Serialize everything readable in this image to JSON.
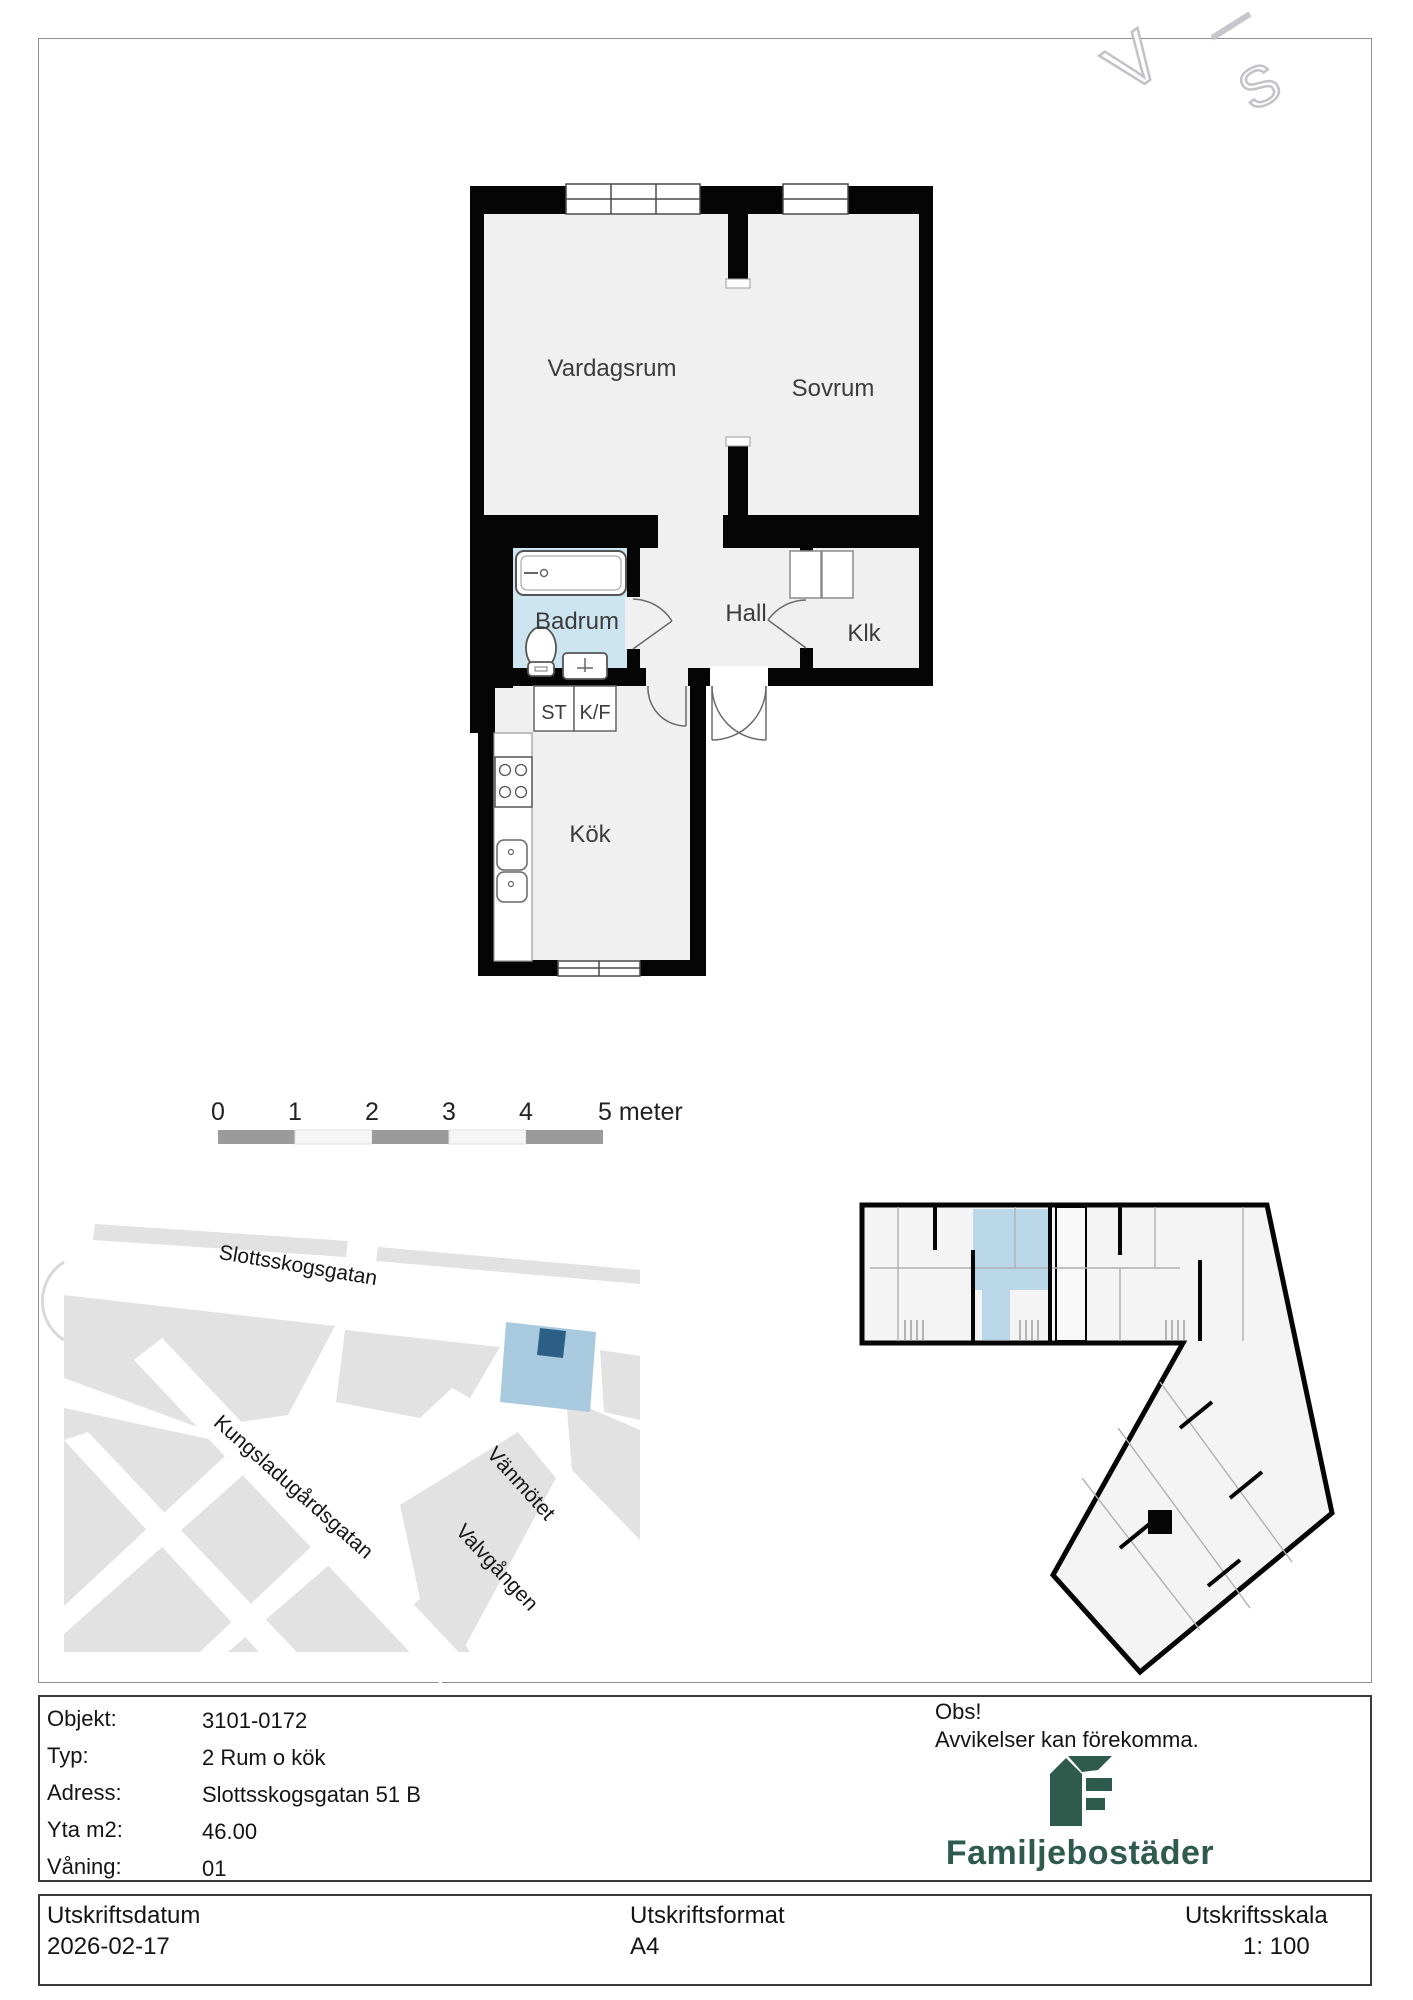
{
  "watermark": {
    "letters": [
      "V",
      "S"
    ]
  },
  "floor_plan": {
    "rooms": [
      {
        "name": "Vardagsrum"
      },
      {
        "name": "Sovrum"
      },
      {
        "name": "Badrum"
      },
      {
        "name": "Hall"
      },
      {
        "name": "Klk"
      },
      {
        "name": "ST"
      },
      {
        "name": "K/F"
      },
      {
        "name": "Kök"
      }
    ]
  },
  "scale_bar": {
    "ticks": [
      "0",
      "1",
      "2",
      "3",
      "4"
    ],
    "end_label": "5 meter"
  },
  "site_map": {
    "streets": [
      {
        "name": "Slottsskogsgatan"
      },
      {
        "name": "Kungsladugårdsgatan"
      },
      {
        "name": "Vänmötet"
      },
      {
        "name": "Valvgången"
      }
    ]
  },
  "info_table": {
    "rows": [
      {
        "label": "Objekt:",
        "value": "3101-0172"
      },
      {
        "label": "Typ:",
        "value": "2 Rum o kök"
      },
      {
        "label": "Adress:",
        "value": "Slottsskogsgatan 51 B"
      },
      {
        "label": "Yta m2:",
        "value": "46.00"
      },
      {
        "label": "Våning:",
        "value": "01"
      }
    ]
  },
  "notice": {
    "title": "Obs!",
    "body": "Avvikelser kan förekomma."
  },
  "brand": {
    "name": "Familjebostäder"
  },
  "footer": {
    "columns": [
      {
        "label": "Utskriftsdatum",
        "value": "2026-02-17"
      },
      {
        "label": "Utskriftsformat",
        "value": "A4"
      },
      {
        "label": "Utskriftsskala",
        "value": "1: 100"
      }
    ]
  },
  "colors": {
    "walls": "#050505",
    "floor": "#f0f0f1",
    "badrum_floor": "#cde5f0",
    "overview_unit": "#b9d7e9",
    "map_block": "#e2e2e3",
    "map_highlight": "#a9cade",
    "map_marker": "#2c5f86",
    "brand_green": "#2e5b4b",
    "scale_gray": "#9b9b9b"
  }
}
